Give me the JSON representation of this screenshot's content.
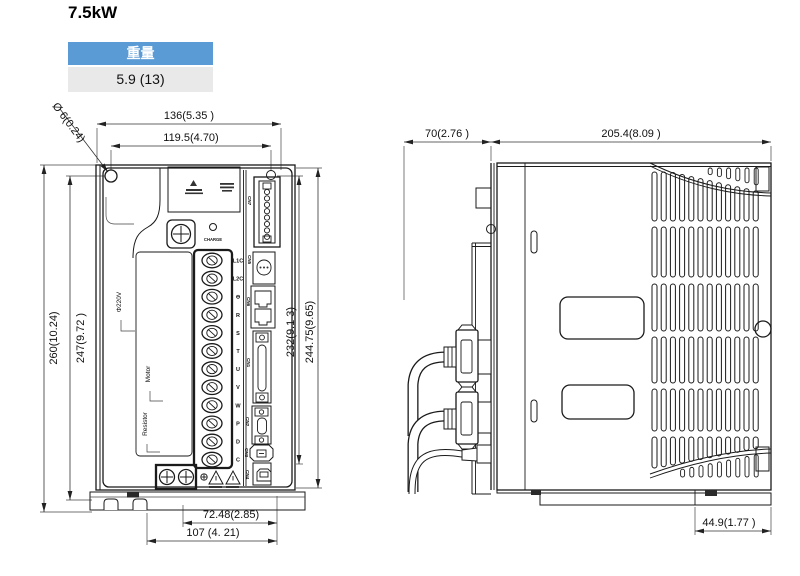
{
  "title": "7.5kW",
  "weight_table": {
    "header": "重量",
    "value": "5.9 (13)"
  },
  "front_view": {
    "dims": {
      "overall_width": "136(5.35 )",
      "hole_pitch_width": "119.5(4.70)",
      "mount_hole": "Ø 6(0.24)",
      "overall_height": "260(10.24)",
      "hole_pitch_height": "247(9.72 )",
      "right_height_inner": "232(9.1 3)",
      "right_height_outer": "244.75(9.65)",
      "bottom_width_inner": "72.48(2.85)",
      "bottom_width_outer": "107 (4. 21)"
    },
    "labels": {
      "charge": "CHARGE",
      "power_group": "Φ220V",
      "motor_group": "Motor",
      "resistor_group": "Resistor"
    },
    "terminal_labels": [
      "L1C",
      "L2C",
      "⊖",
      "R",
      "S",
      "T",
      "U",
      "V",
      "W",
      "P",
      "D",
      "C"
    ],
    "connector_labels": [
      "CN7",
      "CN5",
      "CN6",
      "CN1",
      "CN2",
      "CN3",
      "CN4"
    ]
  },
  "side_view": {
    "dims": {
      "front_depth": "70(2.76 )",
      "body_depth": "205.4(8.09 )",
      "base_depth": "44.9(1.77 )"
    }
  }
}
